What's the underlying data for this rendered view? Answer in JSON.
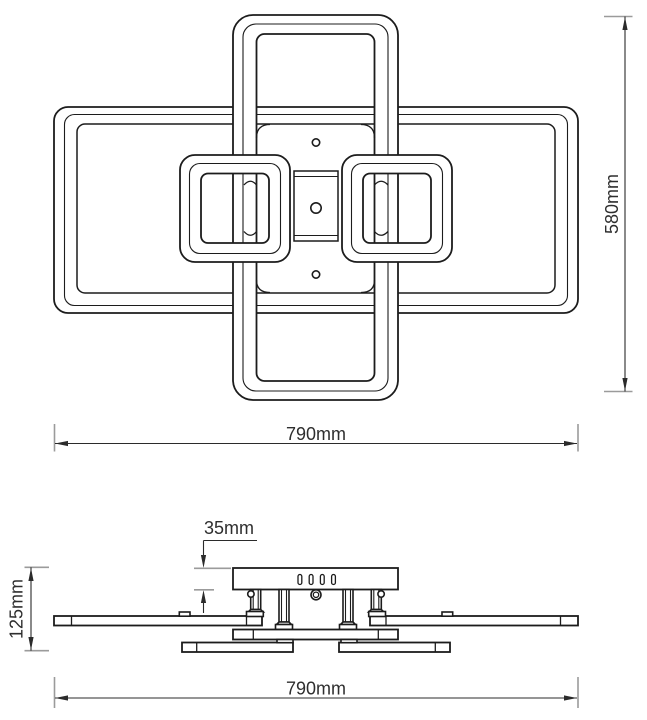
{
  "drawing": {
    "type": "technical-dimension-drawing",
    "subject": "ceiling-light-fixture",
    "units": "mm",
    "colors": {
      "line": "#1c1c1c",
      "dimension": "#2b2b2b",
      "extension_tick": "#9b9b9b",
      "background": "#ffffff"
    },
    "dimensions": {
      "top_view": {
        "width": "790mm",
        "height": "580mm"
      },
      "side_view": {
        "canopy_height": "35mm",
        "fixture_height": "125mm",
        "width": "790mm"
      }
    }
  }
}
